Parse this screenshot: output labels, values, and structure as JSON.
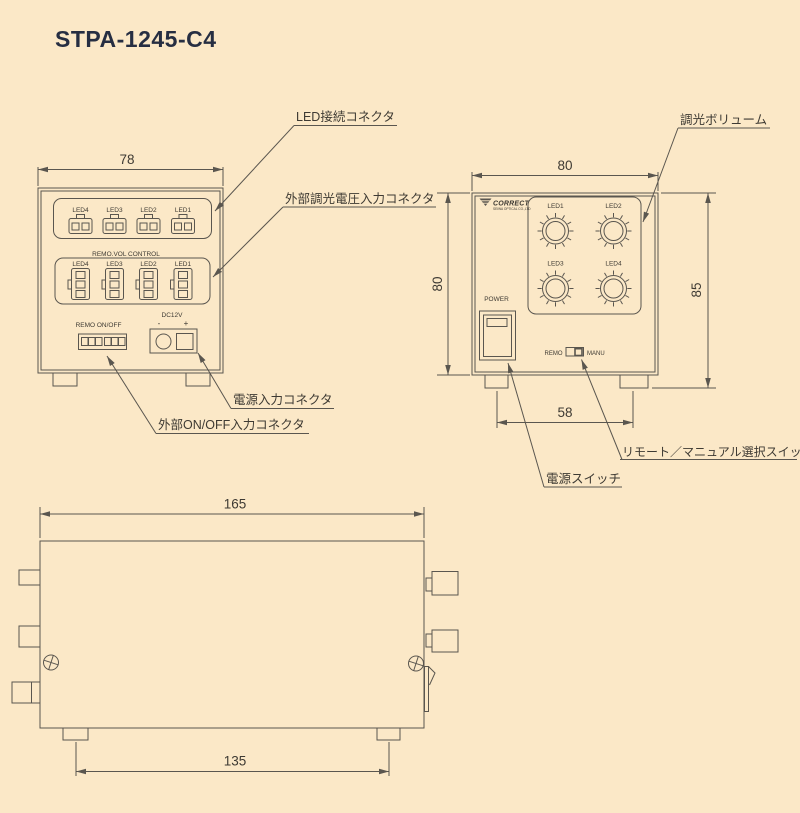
{
  "title": "STPA-1245-C4",
  "colors": {
    "background": "#fbe8c7",
    "line": "#5a564f",
    "text": "#3e3a33",
    "title_text": "#262e42"
  },
  "front_view": {
    "dim_width": "78",
    "led_row": {
      "labels": [
        "LED4",
        "LED3",
        "LED2",
        "LED1"
      ]
    },
    "remo_vol": {
      "title": "REMO.VOL CONTROL",
      "labels": [
        "LED4",
        "LED3",
        "LED2",
        "LED1"
      ]
    },
    "remo_onoff_label": "REMO ON/OFF",
    "dc": {
      "label": "DC12V",
      "minus": "-",
      "plus": "+"
    },
    "callout_led": "LED接続コネクタ",
    "callout_dim_input": "外部調光電圧入力コネクタ",
    "callout_power_input": "電源入力コネクタ",
    "callout_onoff_input": "外部ON/OFF入力コネクタ"
  },
  "panel_view": {
    "dim_width": "80",
    "dim_height": "80",
    "dim_height_with_feet": "85",
    "dim_feet": "58",
    "logo": {
      "name": "CORRECT",
      "sub": "SEIWA OPTICAL CO.,LTD"
    },
    "knobs": [
      "LED1",
      "LED2",
      "LED3",
      "LED4"
    ],
    "power_label": "POWER",
    "mode_switch": {
      "left": "REMO",
      "right": "MANU"
    },
    "callout_volume": "調光ボリューム",
    "callout_mode": "リモート／マニュアル選択スイッチ",
    "callout_power": "電源スイッチ"
  },
  "side_view": {
    "dim_width": "165",
    "dim_feet": "135"
  }
}
